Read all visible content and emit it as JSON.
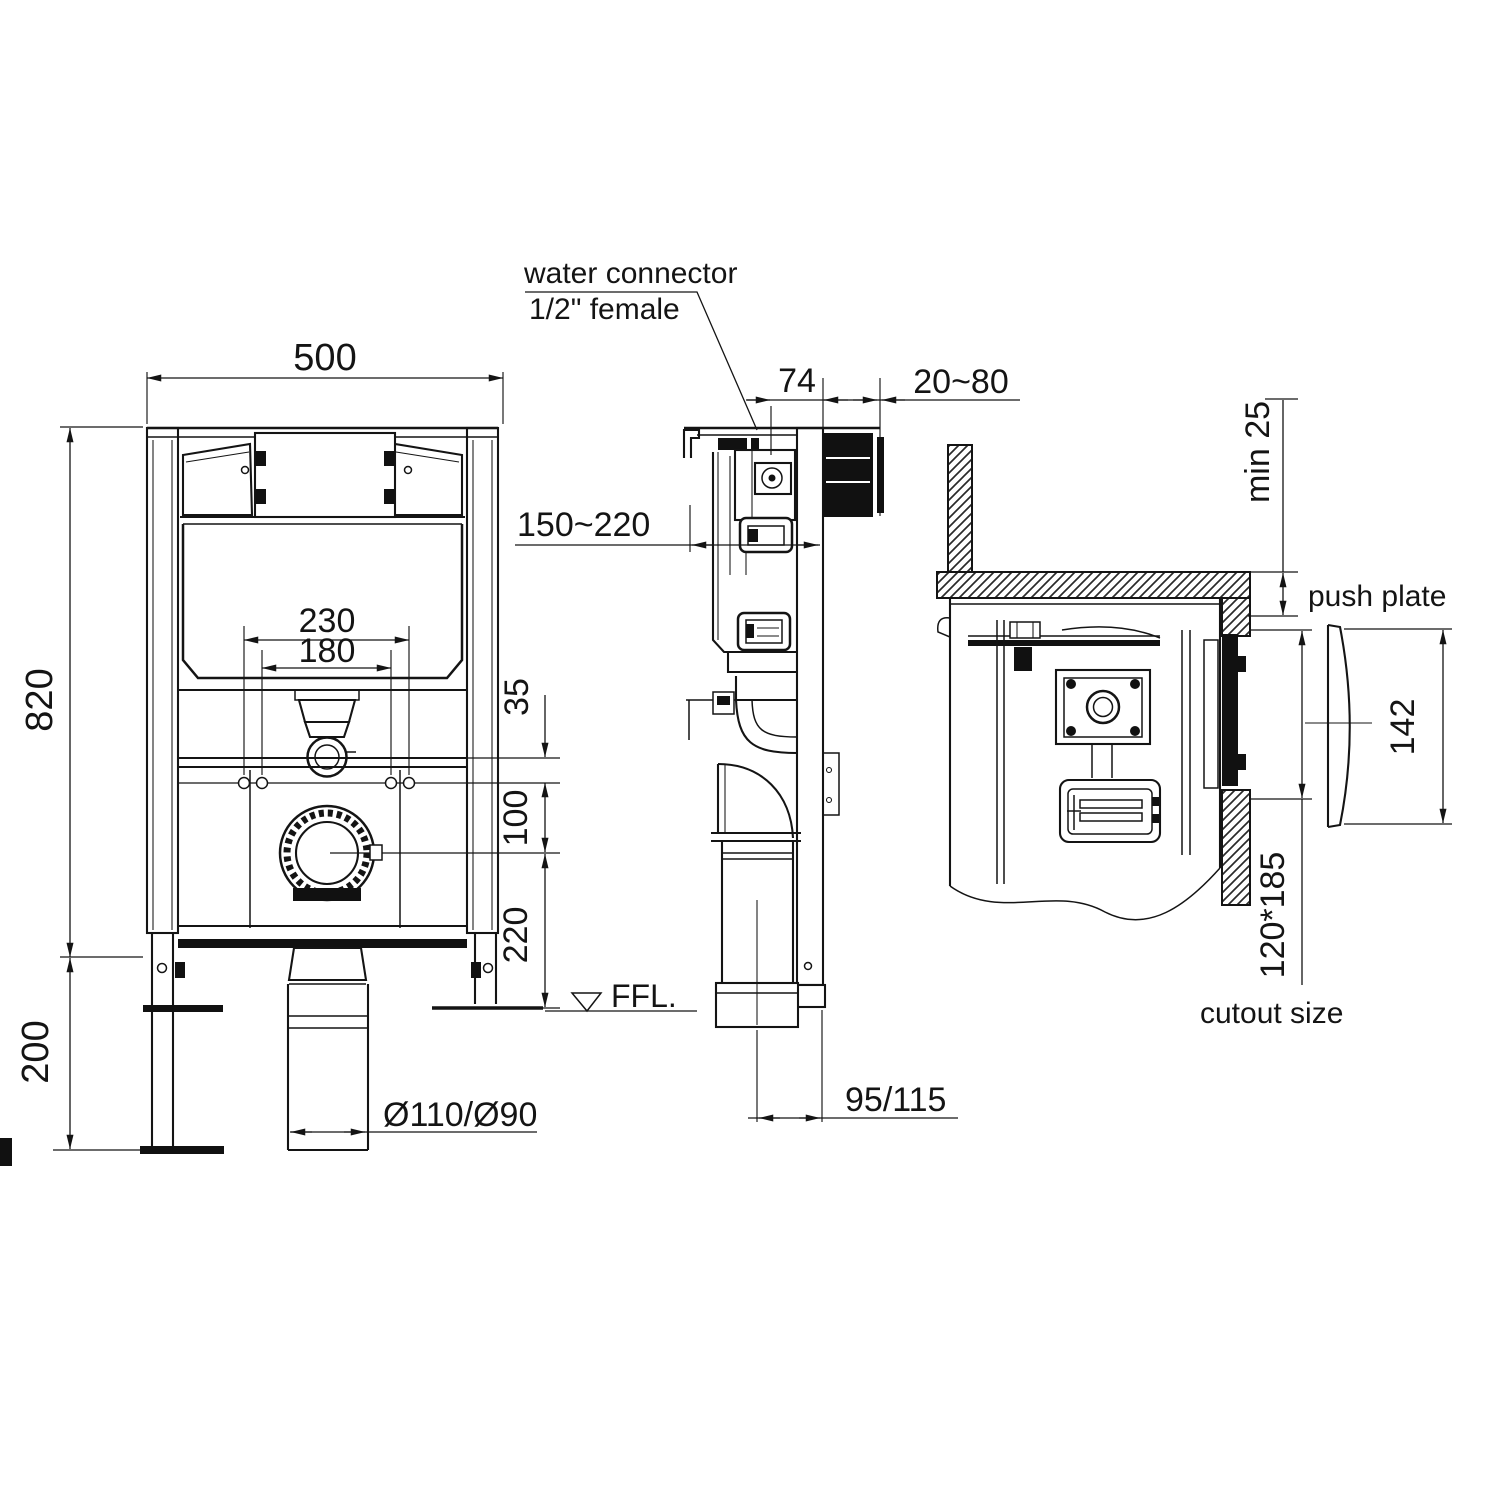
{
  "colors": {
    "ink": "#141414",
    "background": "#ffffff"
  },
  "labels": {
    "water_connector_line1": "water connector",
    "water_connector_line2": "1/2\" female",
    "push_plate": "push plate",
    "cutout_size": "cutout size",
    "ffl_marker": "FFL."
  },
  "dimensions": {
    "frame_width": "500",
    "frame_height": "820",
    "leg_extension": "200",
    "fixing_centres_outer": "230",
    "fixing_centres_inner": "180",
    "offset_top": "35",
    "offset_mid": "100",
    "outlet_height": "220",
    "flush_bend_range": "150~220",
    "inlet_offset": "74",
    "wall_distance": "20~80",
    "min_cover": "min 25",
    "push_plate_height": "142",
    "cutout_dimensions": "120*185",
    "outlet_setback": "95/115",
    "drain_diameter": "Ø110/Ø90"
  }
}
